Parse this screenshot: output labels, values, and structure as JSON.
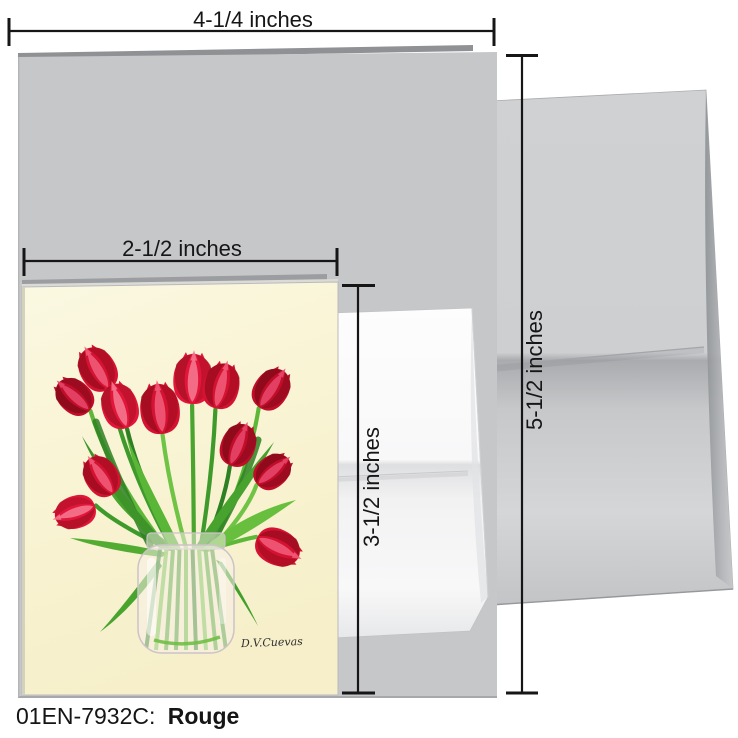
{
  "product": {
    "code": "01EN-7932C:",
    "name": "Rouge"
  },
  "dimensions": {
    "card_width": "4-1/4 inches",
    "card_height": "5-1/2 inches",
    "notecard_width": "2-1/2 inches",
    "notecard_height": "3-1/2 inches"
  },
  "artwork": {
    "signature": "D.V.Cuevas",
    "background": "#faf5d6",
    "tulip_palettes": [
      [
        "#9e0c20",
        "#d41231",
        "#f05a78"
      ],
      [
        "#860a1a",
        "#c00e2a",
        "#e64568"
      ],
      [
        "#ad1026",
        "#e2163a",
        "#f5758f"
      ]
    ],
    "stem_greens": [
      "#3f9a2c",
      "#5eb838",
      "#2e8023",
      "#6fc345",
      "#4aa52f"
    ],
    "leaf_greens": [
      "#3e9429",
      "#5ab636",
      "#47a22e",
      "#68bf3d",
      "#52ac32",
      "#49a42e",
      "#41a02b",
      "#5bb437"
    ],
    "jar_tint": "#f7efe7",
    "jar_outline": "#ccc3c7"
  },
  "colors": {
    "page_background": "#ffffff",
    "large_card": "#c6c7c9",
    "large_card_back_edge": "#8f9194",
    "small_card_back_edge": "#9b9da0",
    "dimension_line": "#161616"
  }
}
